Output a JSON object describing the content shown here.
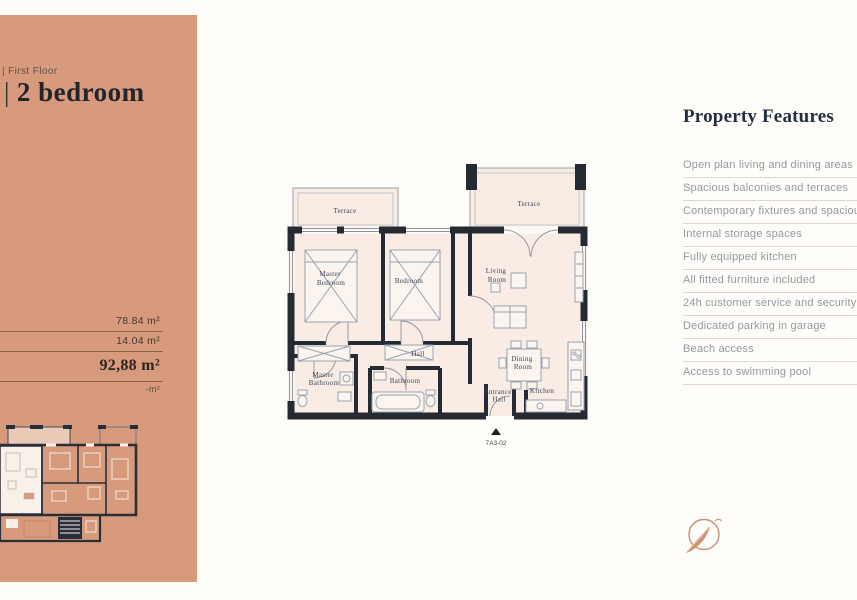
{
  "page": {
    "background": "#fffdfa"
  },
  "colors": {
    "sidebar_bg": "#d89a7d",
    "accent": "#c88e73",
    "wall": "#262a33",
    "room_fill": "#f8ece5",
    "features_text": "#93999f",
    "heading_text": "#242e3e"
  },
  "sidebar": {
    "floor_label": "| First Floor",
    "title_prefix": "|",
    "title": "2 bedroom",
    "areas": [
      "78.84 m²",
      "14.04 m²",
      "92,88 m²",
      "-m²"
    ]
  },
  "plan": {
    "unit_code": "7A3-02",
    "rooms": {
      "terrace_left": "Terrace",
      "terrace_right": "Terrace",
      "master_bedroom": [
        "Master",
        "Bedroom"
      ],
      "bedroom": "Bedroom",
      "living_room": [
        "Living",
        "Room"
      ],
      "hall": "Hall",
      "master_bathroom": [
        "Master",
        "Bathroom"
      ],
      "bathroom": "Bathroom",
      "entrance_hall": [
        "Entrance",
        "Hall"
      ],
      "dining_room": [
        "Dining",
        "Room"
      ],
      "kitchen": "Kitchen"
    }
  },
  "features": {
    "heading": "Property Features",
    "items": [
      "Open plan living and dining areas",
      "Spacious balconies and terraces",
      "Contemporary fixtures and spacious layouts",
      "Internal storage spaces",
      "Fully equipped kitchen",
      "All fitted furniture included",
      "24h customer service and security",
      "Dedicated parking in garage",
      "Beach access",
      "Access to swimming pool"
    ]
  }
}
